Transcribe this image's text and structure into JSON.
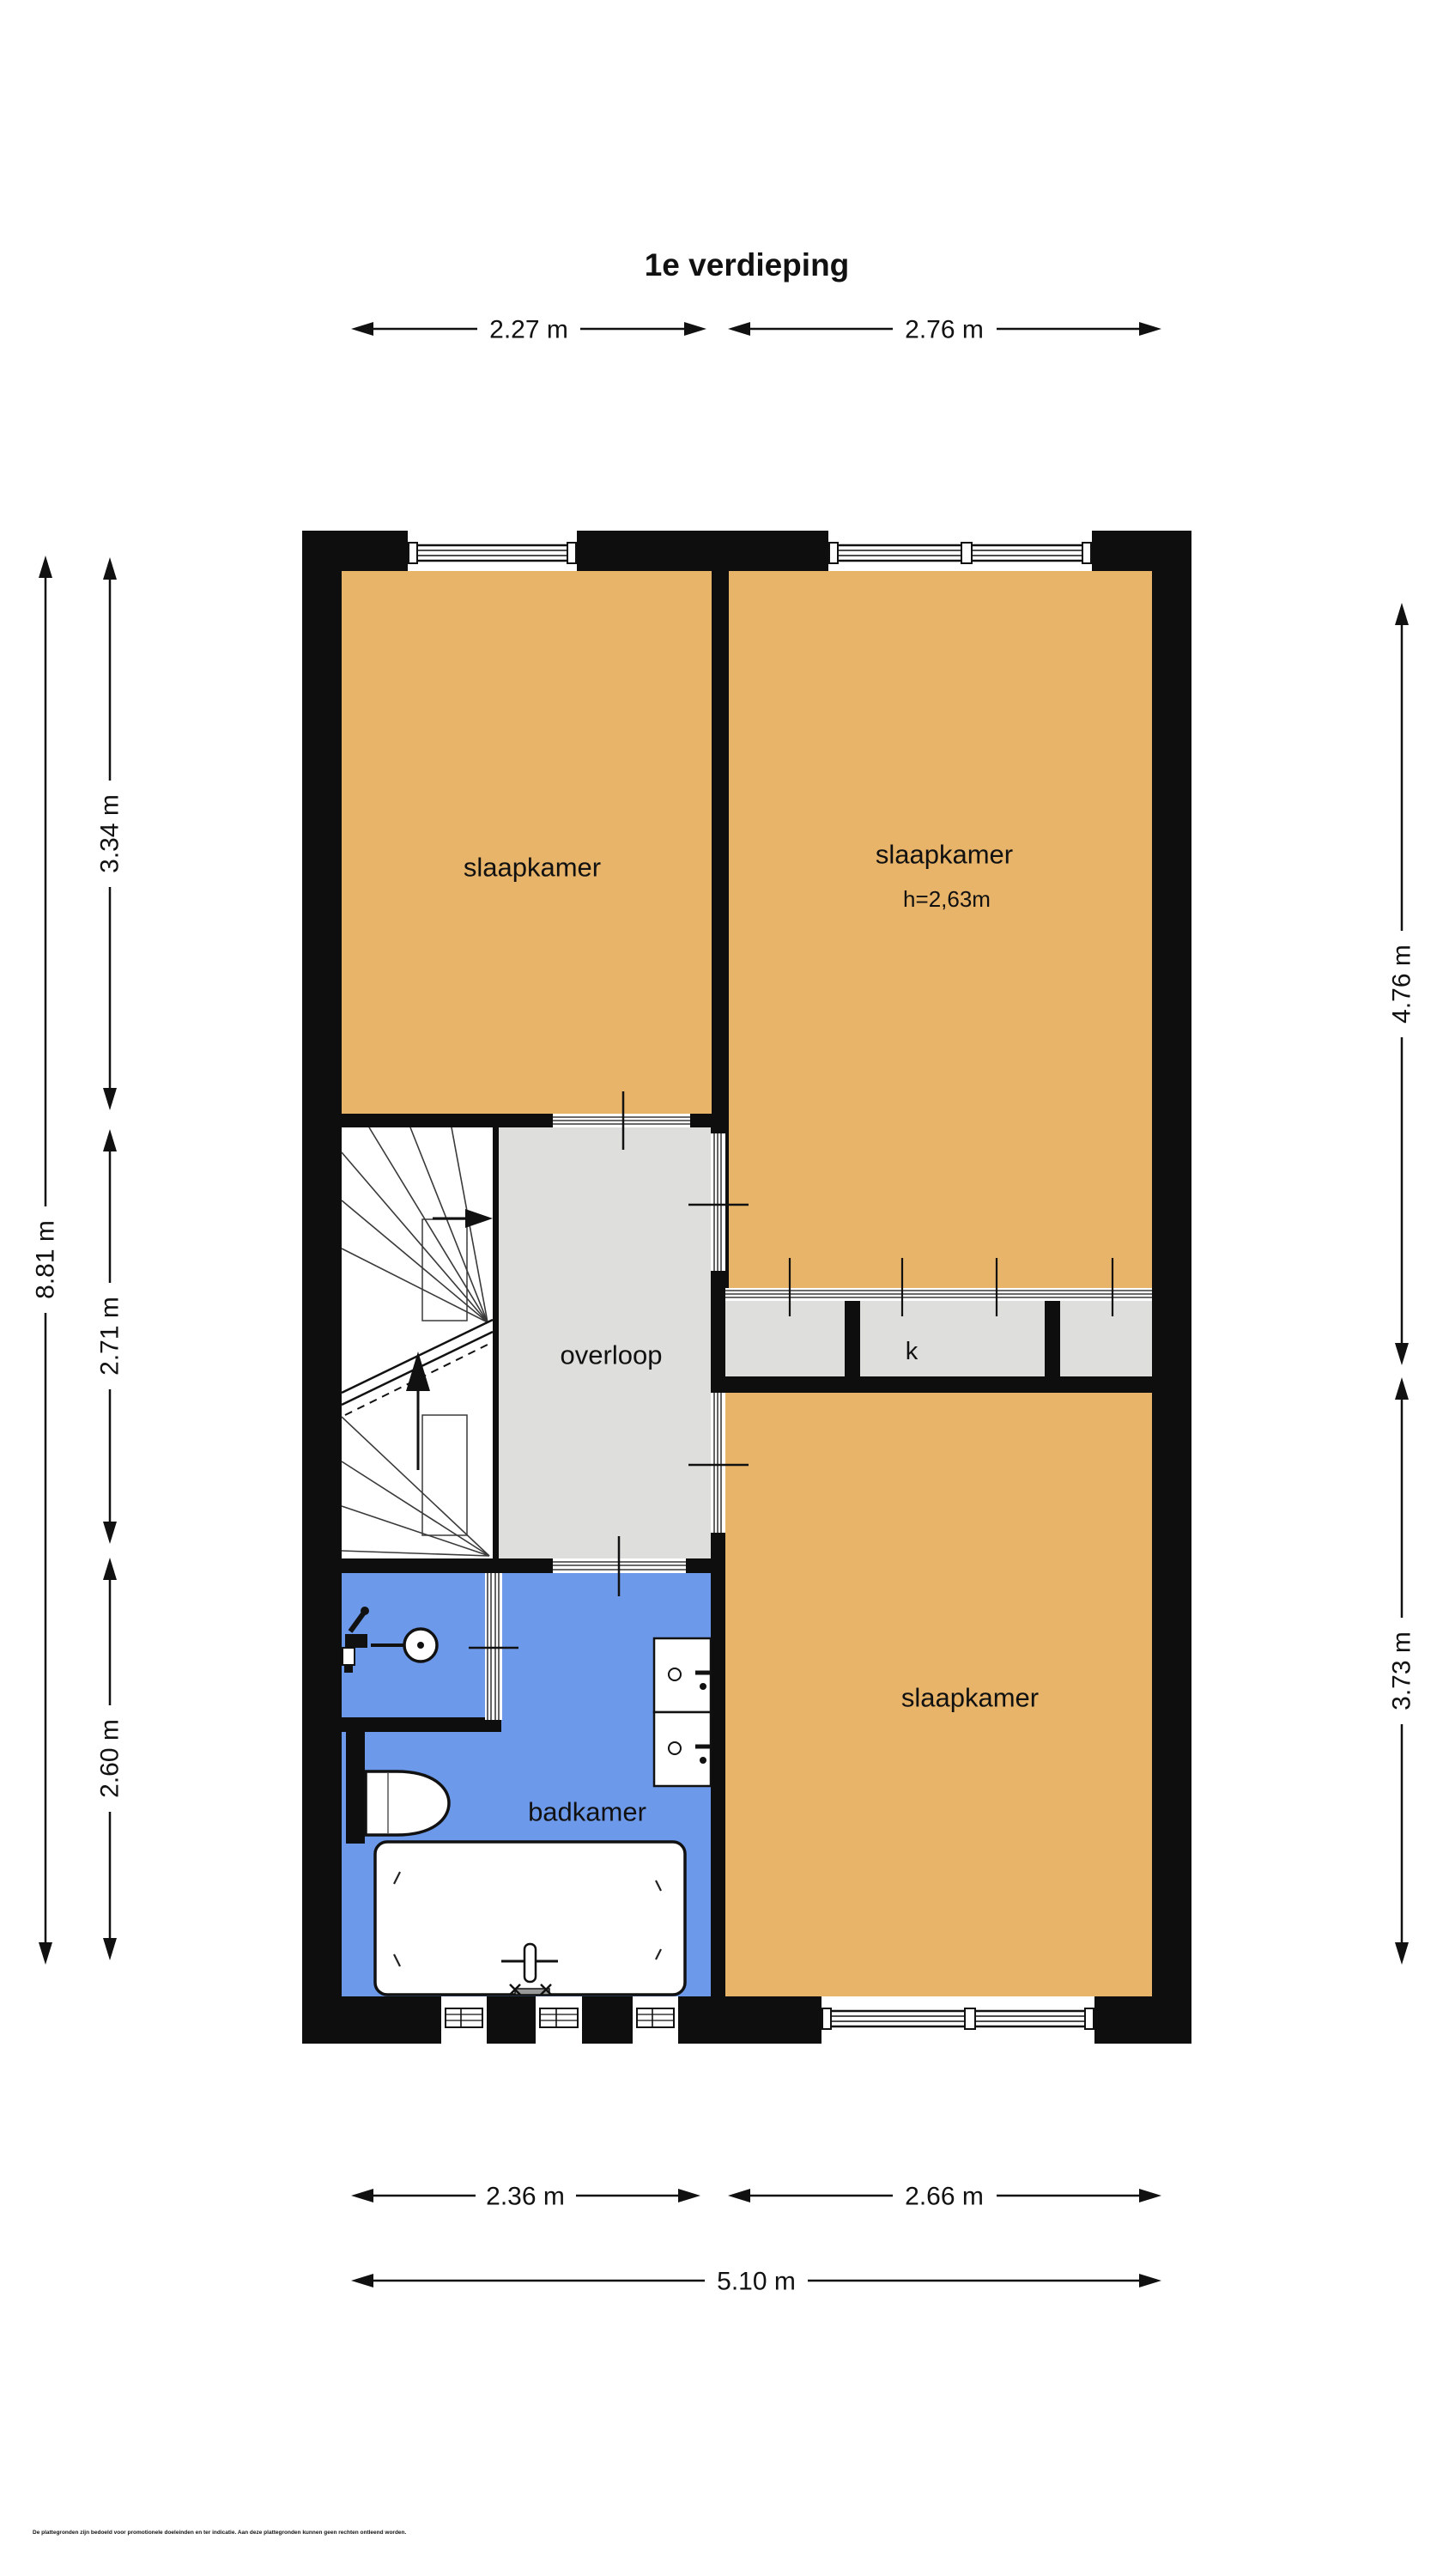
{
  "title": "1e verdieping",
  "plan": {
    "rooms": {
      "bedroom_top_left": {
        "label": "slaapkamer"
      },
      "bedroom_top_right": {
        "label": "slaapkamer",
        "ceiling_height": "h=2,63m"
      },
      "landing": {
        "label": "overloop"
      },
      "closet": {
        "label": "k"
      },
      "bedroom_bottom_right": {
        "label": "slaapkamer"
      },
      "bathroom": {
        "label": "badkamer"
      }
    },
    "fixtures": [
      "stairs",
      "shower",
      "toilet",
      "washbasin",
      "washbasin",
      "bathtub"
    ],
    "colors": {
      "room_fill": "#E7B469",
      "landing_fill": "#DEDEDC",
      "bathroom_fill": "#6D99EB",
      "wall": "#0E0E0E",
      "stair_fill": "#FFFFFF"
    }
  },
  "dimensions": {
    "top": [
      "2.27 m",
      "2.76 m"
    ],
    "bottom": [
      "2.36 m",
      "2.66 m"
    ],
    "bottom_total": "5.10 m",
    "left_total": "8.81 m",
    "left": [
      "3.34 m",
      "2.71 m",
      "2.60 m"
    ],
    "right": [
      "4.76 m",
      "3.73 m"
    ]
  },
  "disclaimer": "De plattegronden zijn bedoeld voor promotionele doeleinden en ter indicatie. Aan deze plattegronden kunnen geen rechten ontleend worden."
}
